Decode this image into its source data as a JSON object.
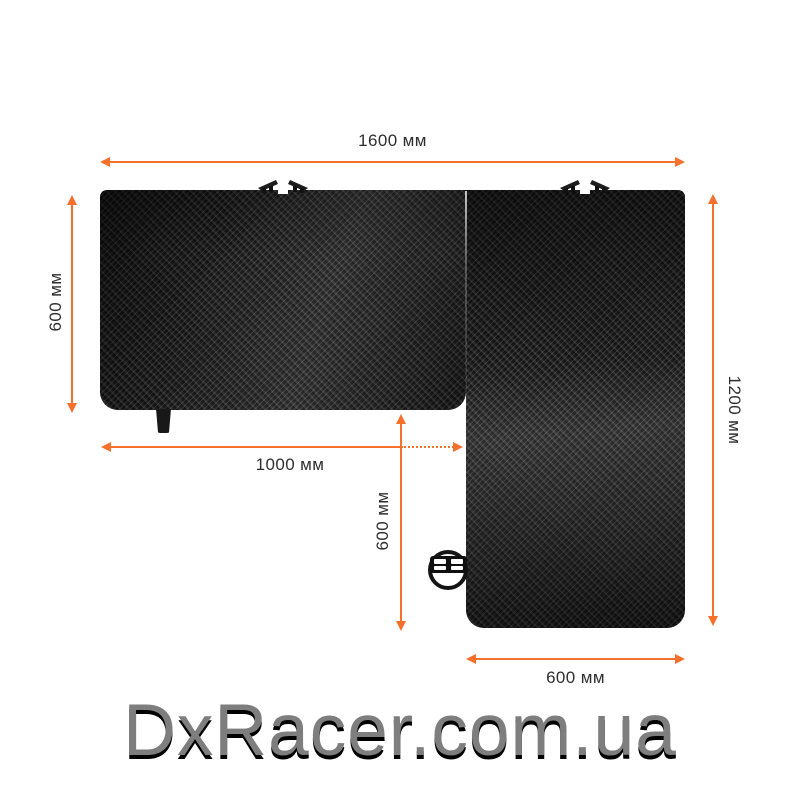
{
  "diagram": {
    "name": "l-shaped-gaming-desk-top-view",
    "dimensions": {
      "top_width": {
        "label": "1600 мм"
      },
      "left_depth": {
        "label": "600 мм"
      },
      "right_depth": {
        "label": "1200 мм"
      },
      "left_section_width": {
        "label": "1000 мм"
      },
      "return_depth": {
        "label": "600 мм"
      },
      "return_width": {
        "label": "600 мм"
      }
    },
    "colors": {
      "accent": "#f4702b",
      "label_text": "#2e2e2e",
      "desk_base": "#262626",
      "watermark_text": "#7e7e7e",
      "watermark_shadow": "#000000"
    }
  },
  "watermark": {
    "text": "DxRacer.com.ua"
  }
}
